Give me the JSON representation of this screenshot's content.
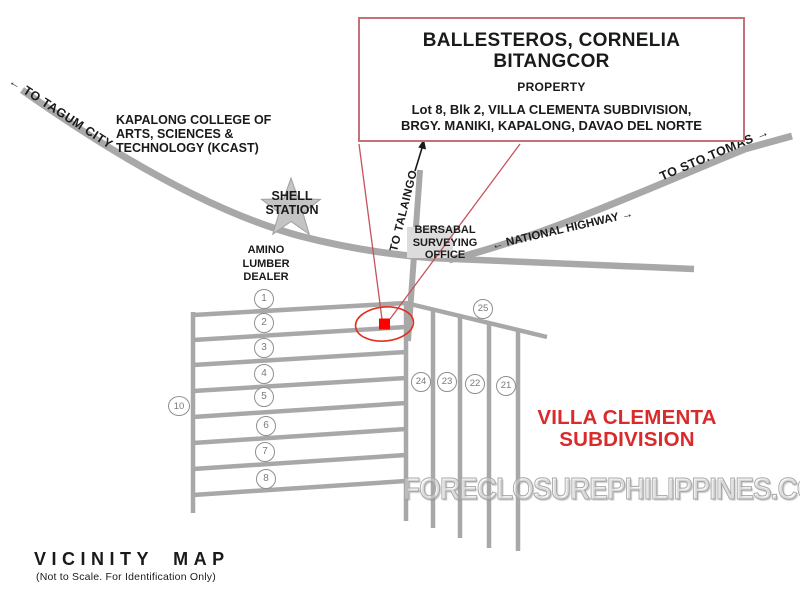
{
  "map": {
    "property_box": {
      "owner": "BALLESTEROS, CORNELIA\nBITANGCOR",
      "label": "PROPERTY",
      "address": "Lot 8, Blk 2, VILLA CLEMENTA SUBDIVISION,\nBRGY. MANIKI, KAPALONG, DAVAO DEL NORTE"
    },
    "landmarks": {
      "kcast": "KAPALONG COLLEGE OF\nARTS, SCIENCES &\nTECHNOLOGY (KCAST)",
      "shell_station": "SHELL\nSTATION",
      "amino_lumber": "AMINO\nLUMBER\nDEALER",
      "bersabal": "BERSABAL\nSURVEYING\nOFFICE"
    },
    "road_labels": {
      "to_tagum": "← TO TAGUM CITY",
      "to_talaingo": "TO TALAINGO",
      "national_highway": "← NATIONAL HIGHWAY →",
      "to_sto_tomas": "TO STO.TOMAS →"
    },
    "subdivision_name": "VILLA CLEMENTA\nSUBDIVISION",
    "lot_markers": {
      "rows_left": [
        "1",
        "2",
        "3",
        "4",
        "5",
        "6",
        "7",
        "8"
      ],
      "outer_left": "10",
      "top_right": "25",
      "row_right": [
        "24",
        "23",
        "22",
        "21"
      ]
    }
  },
  "watermark": "FORECLOSUREPHILIPPINES.COM",
  "footer": {
    "title": "VICINITY MAP",
    "note": "(Not to Scale. For Identification Only)"
  },
  "colors": {
    "road_gray": "#A8A8A8",
    "box_border_red": "#C77078",
    "leader_red": "#C5535B",
    "ellipse_red": "#E0301E",
    "marker_red": "#FF0000",
    "subdivision_text_red": "#D92B2B",
    "star_gray": "#C4C4C4",
    "text_black": "#1A1A1A"
  }
}
